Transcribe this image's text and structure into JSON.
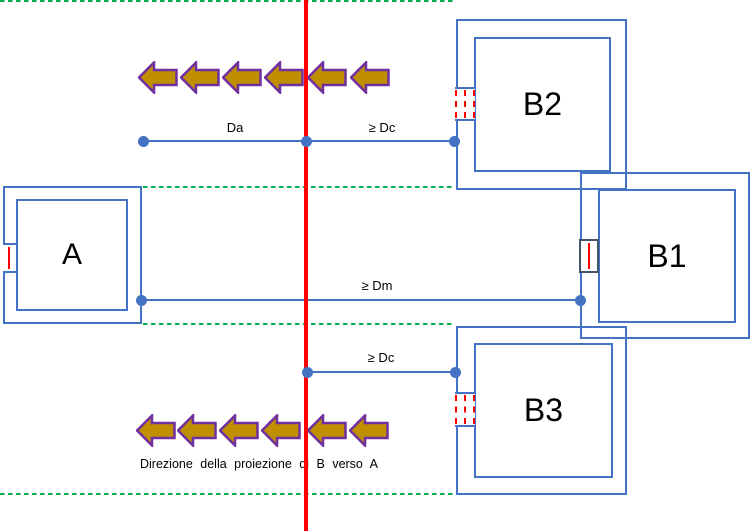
{
  "diagram": {
    "caption": "Direzione della proiezione di B verso A",
    "boxes": {
      "a": {
        "label": "A"
      },
      "b1": {
        "label": "B1"
      },
      "b2": {
        "label": "B2"
      },
      "b3": {
        "label": "B3"
      }
    },
    "dimensions": {
      "da": {
        "label": "Da"
      },
      "dc_top": {
        "label": "≥ Dc"
      },
      "dm": {
        "label": "≥ Dm"
      },
      "dc_bottom": {
        "label": "≥ Dc"
      }
    },
    "arrows": {
      "direction": "left",
      "top_row_count": 6,
      "bottom_row_count": 6
    },
    "colors": {
      "line_blue": "#4472C4",
      "axis_red": "#FF0000",
      "guide_green": "#00B050",
      "arrow_fill": "#BF8F00",
      "arrow_outline": "#7030A0",
      "port_dark": "#44546A",
      "port_red": "#FF0000"
    }
  }
}
